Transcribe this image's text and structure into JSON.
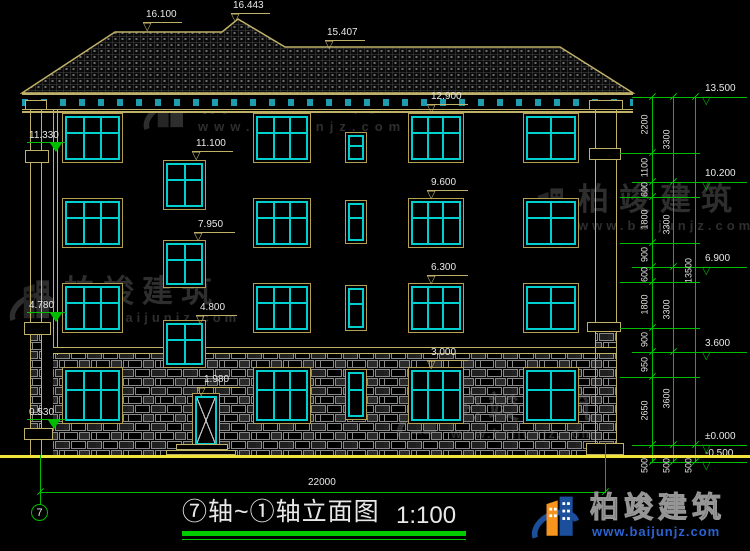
{
  "title_block": {
    "title": "⑦轴~①轴立面图",
    "scale": "1:100"
  },
  "axis_bubble": "7",
  "annotations": {
    "roof": [
      "16.100",
      "16.443",
      "15.407"
    ],
    "facade": [
      "12.900",
      "11.100",
      "9.600",
      "7.950",
      "6.300",
      "4.800",
      "3.000",
      "1.980"
    ],
    "left": [
      "11.330",
      "4.780",
      "0.530"
    ],
    "right": [
      "13.500",
      "10.200",
      "6.900",
      "3.600",
      "±0.000",
      "-0.500"
    ]
  },
  "dims": {
    "inner": [
      "2200",
      "1100",
      "600",
      "1800",
      "900",
      "600",
      "1800",
      "900",
      "950",
      "2650",
      "500"
    ],
    "middle": [
      "3300",
      "3300",
      "3300",
      "3600",
      "500"
    ],
    "outer": [
      "13500",
      "500"
    ],
    "total": "22000"
  },
  "watermark": {
    "brand": "柏竣建筑",
    "url": "www.baijunjz.com"
  },
  "logo": {
    "brand": "柏竣建筑",
    "url": "www.baijunjz.com"
  },
  "colors": {
    "line_tan": "#c0b168",
    "line_cyan": "#00cfcf",
    "dim_green": "#00bd00",
    "ground_yellow": "#f2e43c",
    "text_white": "#e8e8e8",
    "watermark_gray": "#2e2e2e",
    "logo_blue": "#2b62cf",
    "logo_orange": "#f7941d"
  }
}
